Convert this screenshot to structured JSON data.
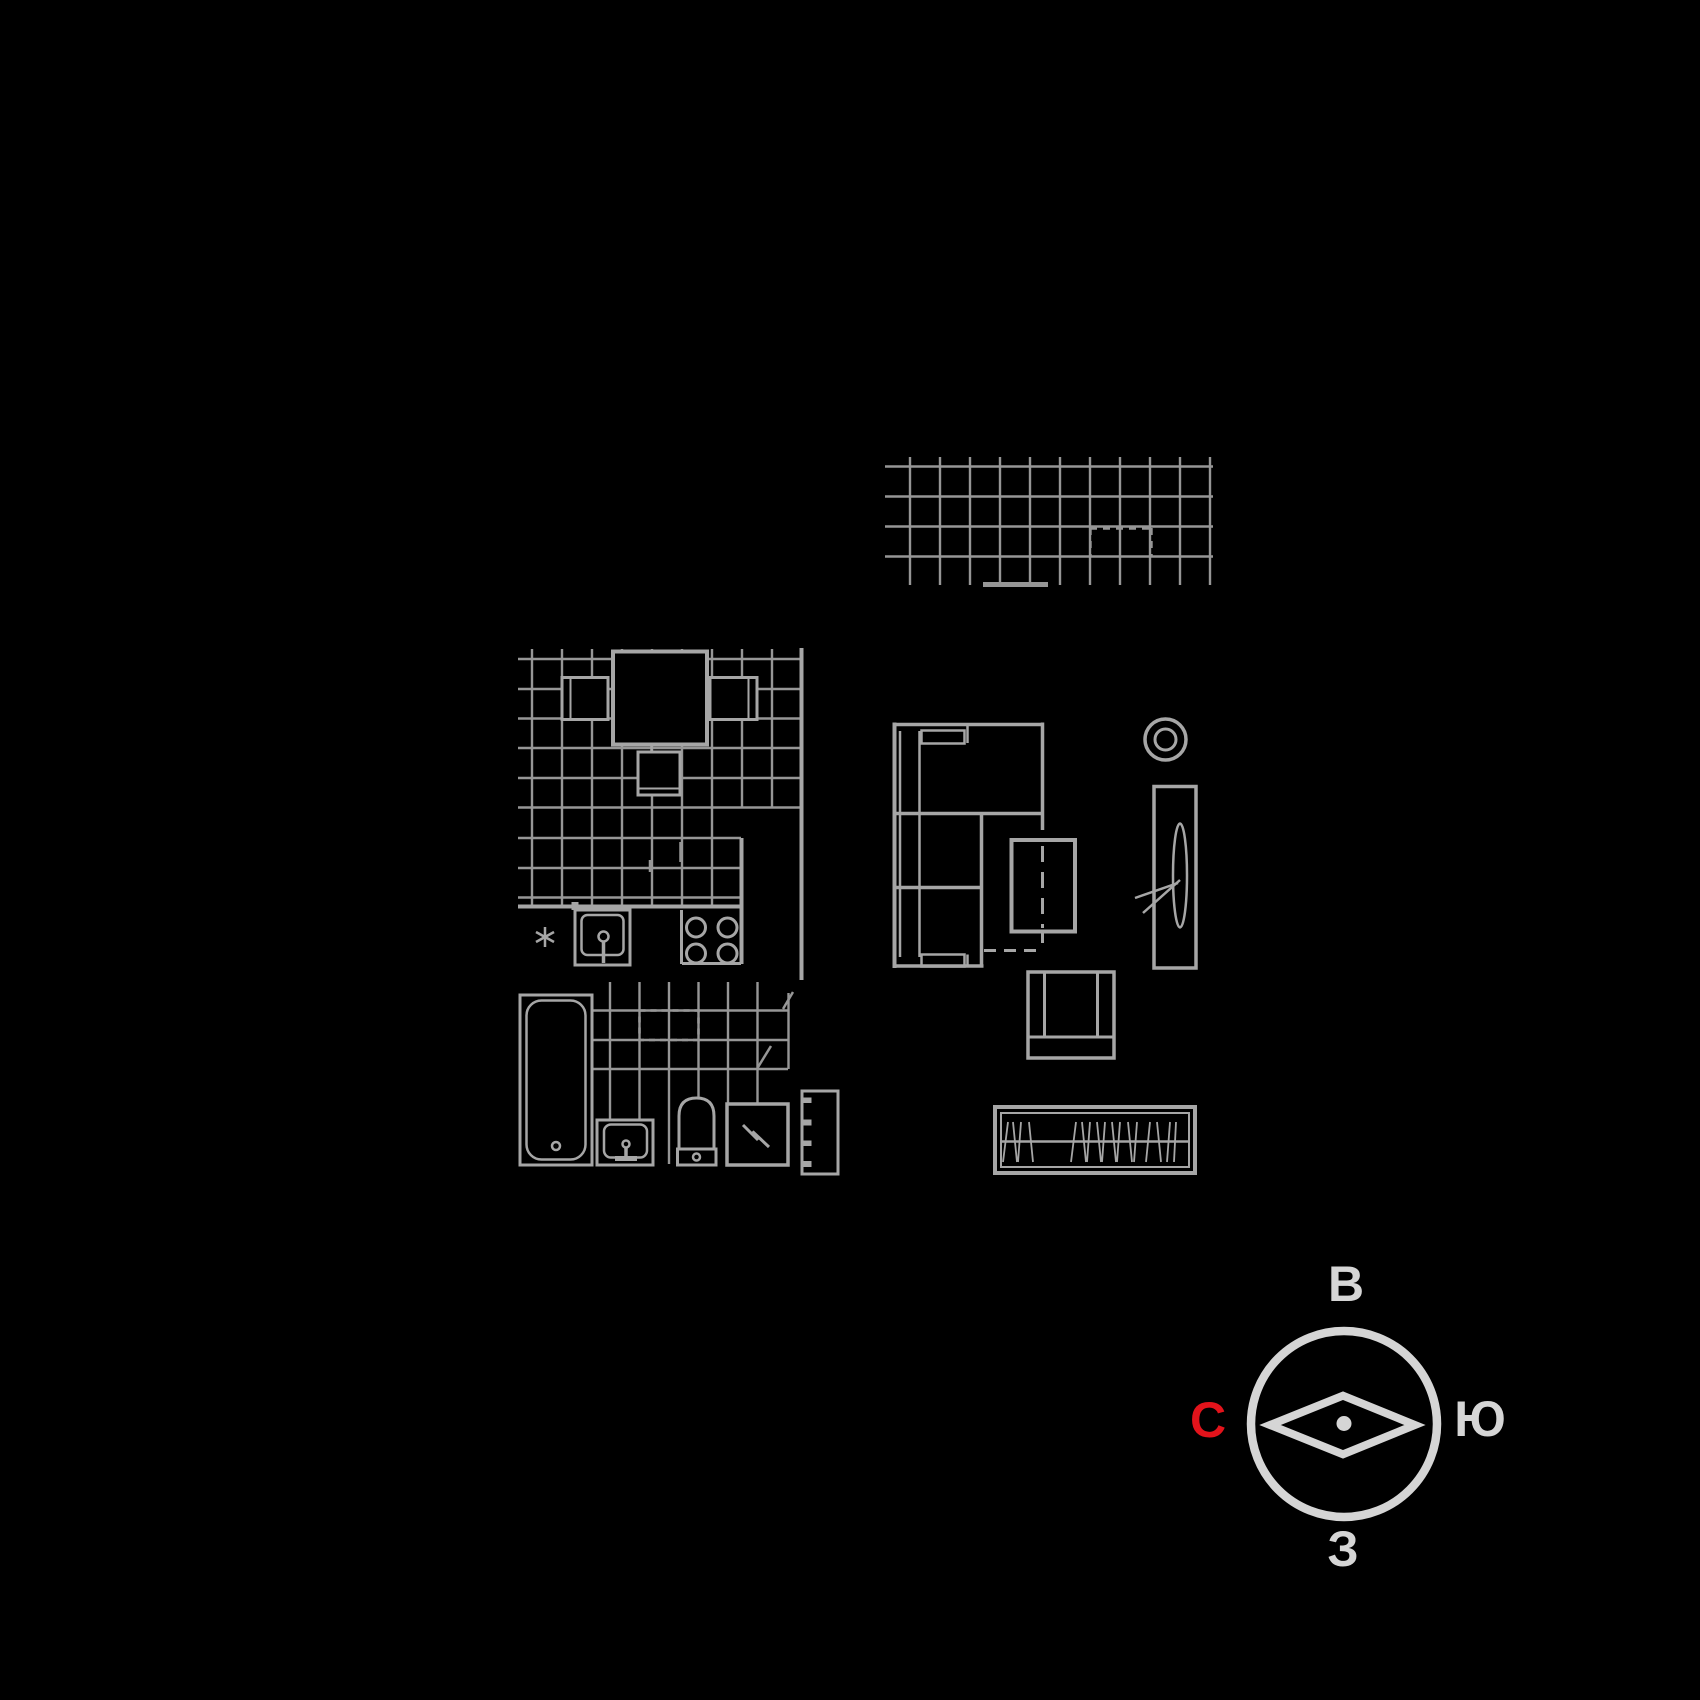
{
  "title": "Apartment furniture floor plan",
  "compass": {
    "top_label": "В",
    "right_label": "Ю",
    "bottom_label": "З",
    "left_label": "С"
  },
  "colors": {
    "background": "#000000",
    "tile_grid_line": "#969696",
    "fixture_line": "#a6a6a6",
    "compass_gray": "#d5d5d5",
    "compass_left_red": "#e3131b"
  },
  "elements": [
    "balcony-glazing-grid",
    "kitchen-tile-grid",
    "dining-table-with-three-chairs",
    "kitchen-sink",
    "cold-water-asterisk",
    "stove-four-burners",
    "bathtub",
    "washbasin",
    "toilet",
    "washing-machine",
    "heated-towel-rail",
    "corner-sofa",
    "folding-table",
    "armchair",
    "ceiling-lamp",
    "tv-stand",
    "wardrobe-with-hangers",
    "compass-rose"
  ]
}
